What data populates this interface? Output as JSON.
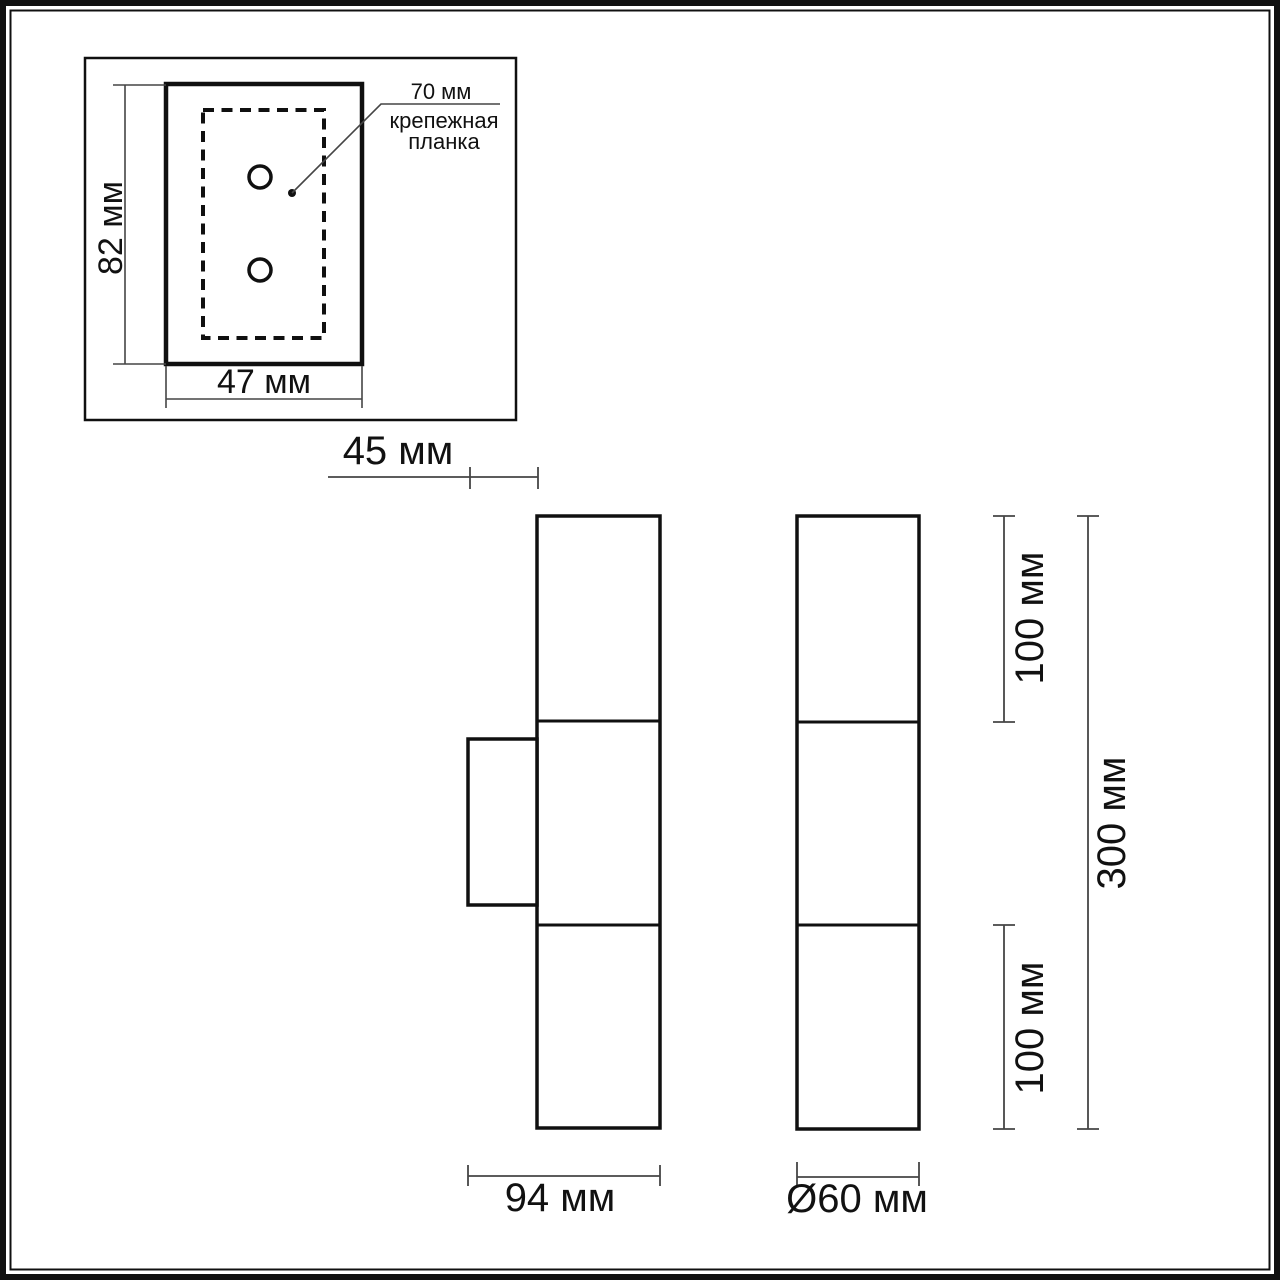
{
  "colors": {
    "background": "#ffffff",
    "outline": "#101010",
    "dimension_line": "#454545",
    "text": "#111111"
  },
  "mounting_plate_detail": {
    "height_label": "82 мм",
    "width_label": "47 мм",
    "hole_spacing_label": "70 мм",
    "caption_line1": "крепежная",
    "caption_line2": "планка"
  },
  "side_view": {
    "wall_gap_label": "45 мм",
    "depth_label": "94 мм"
  },
  "front_view": {
    "upper_section_label": "100 мм",
    "lower_section_label": "100 мм",
    "overall_height_label": "300 мм",
    "diameter_label": "Ø60 мм"
  }
}
